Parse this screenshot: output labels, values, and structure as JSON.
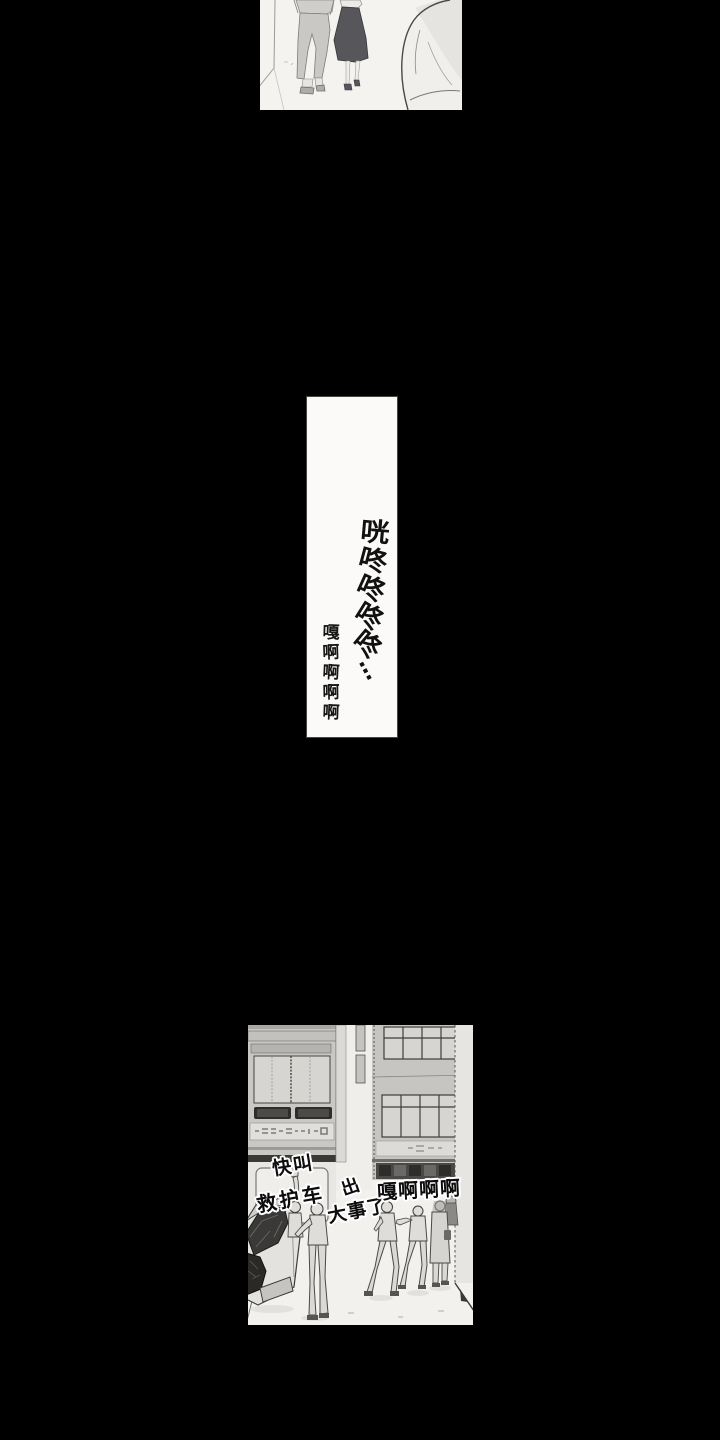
{
  "page": {
    "background_color": "#000000",
    "paper_color": "#f4f3f0",
    "ink_color": "#111111"
  },
  "panel_middle": {
    "sfx_chars": [
      "咣",
      "咚",
      "咚",
      "咚",
      "咚"
    ],
    "sfx_ellipsis": "…",
    "scream_chars": [
      "嘎",
      "啊",
      "啊",
      "啊",
      "啊"
    ]
  },
  "panel_bottom": {
    "speech_call_1": "快叫",
    "speech_call_2": "救护车",
    "speech_big_1": "出",
    "speech_big_2": "大事了",
    "speech_scream": "嘎啊啊啊"
  }
}
